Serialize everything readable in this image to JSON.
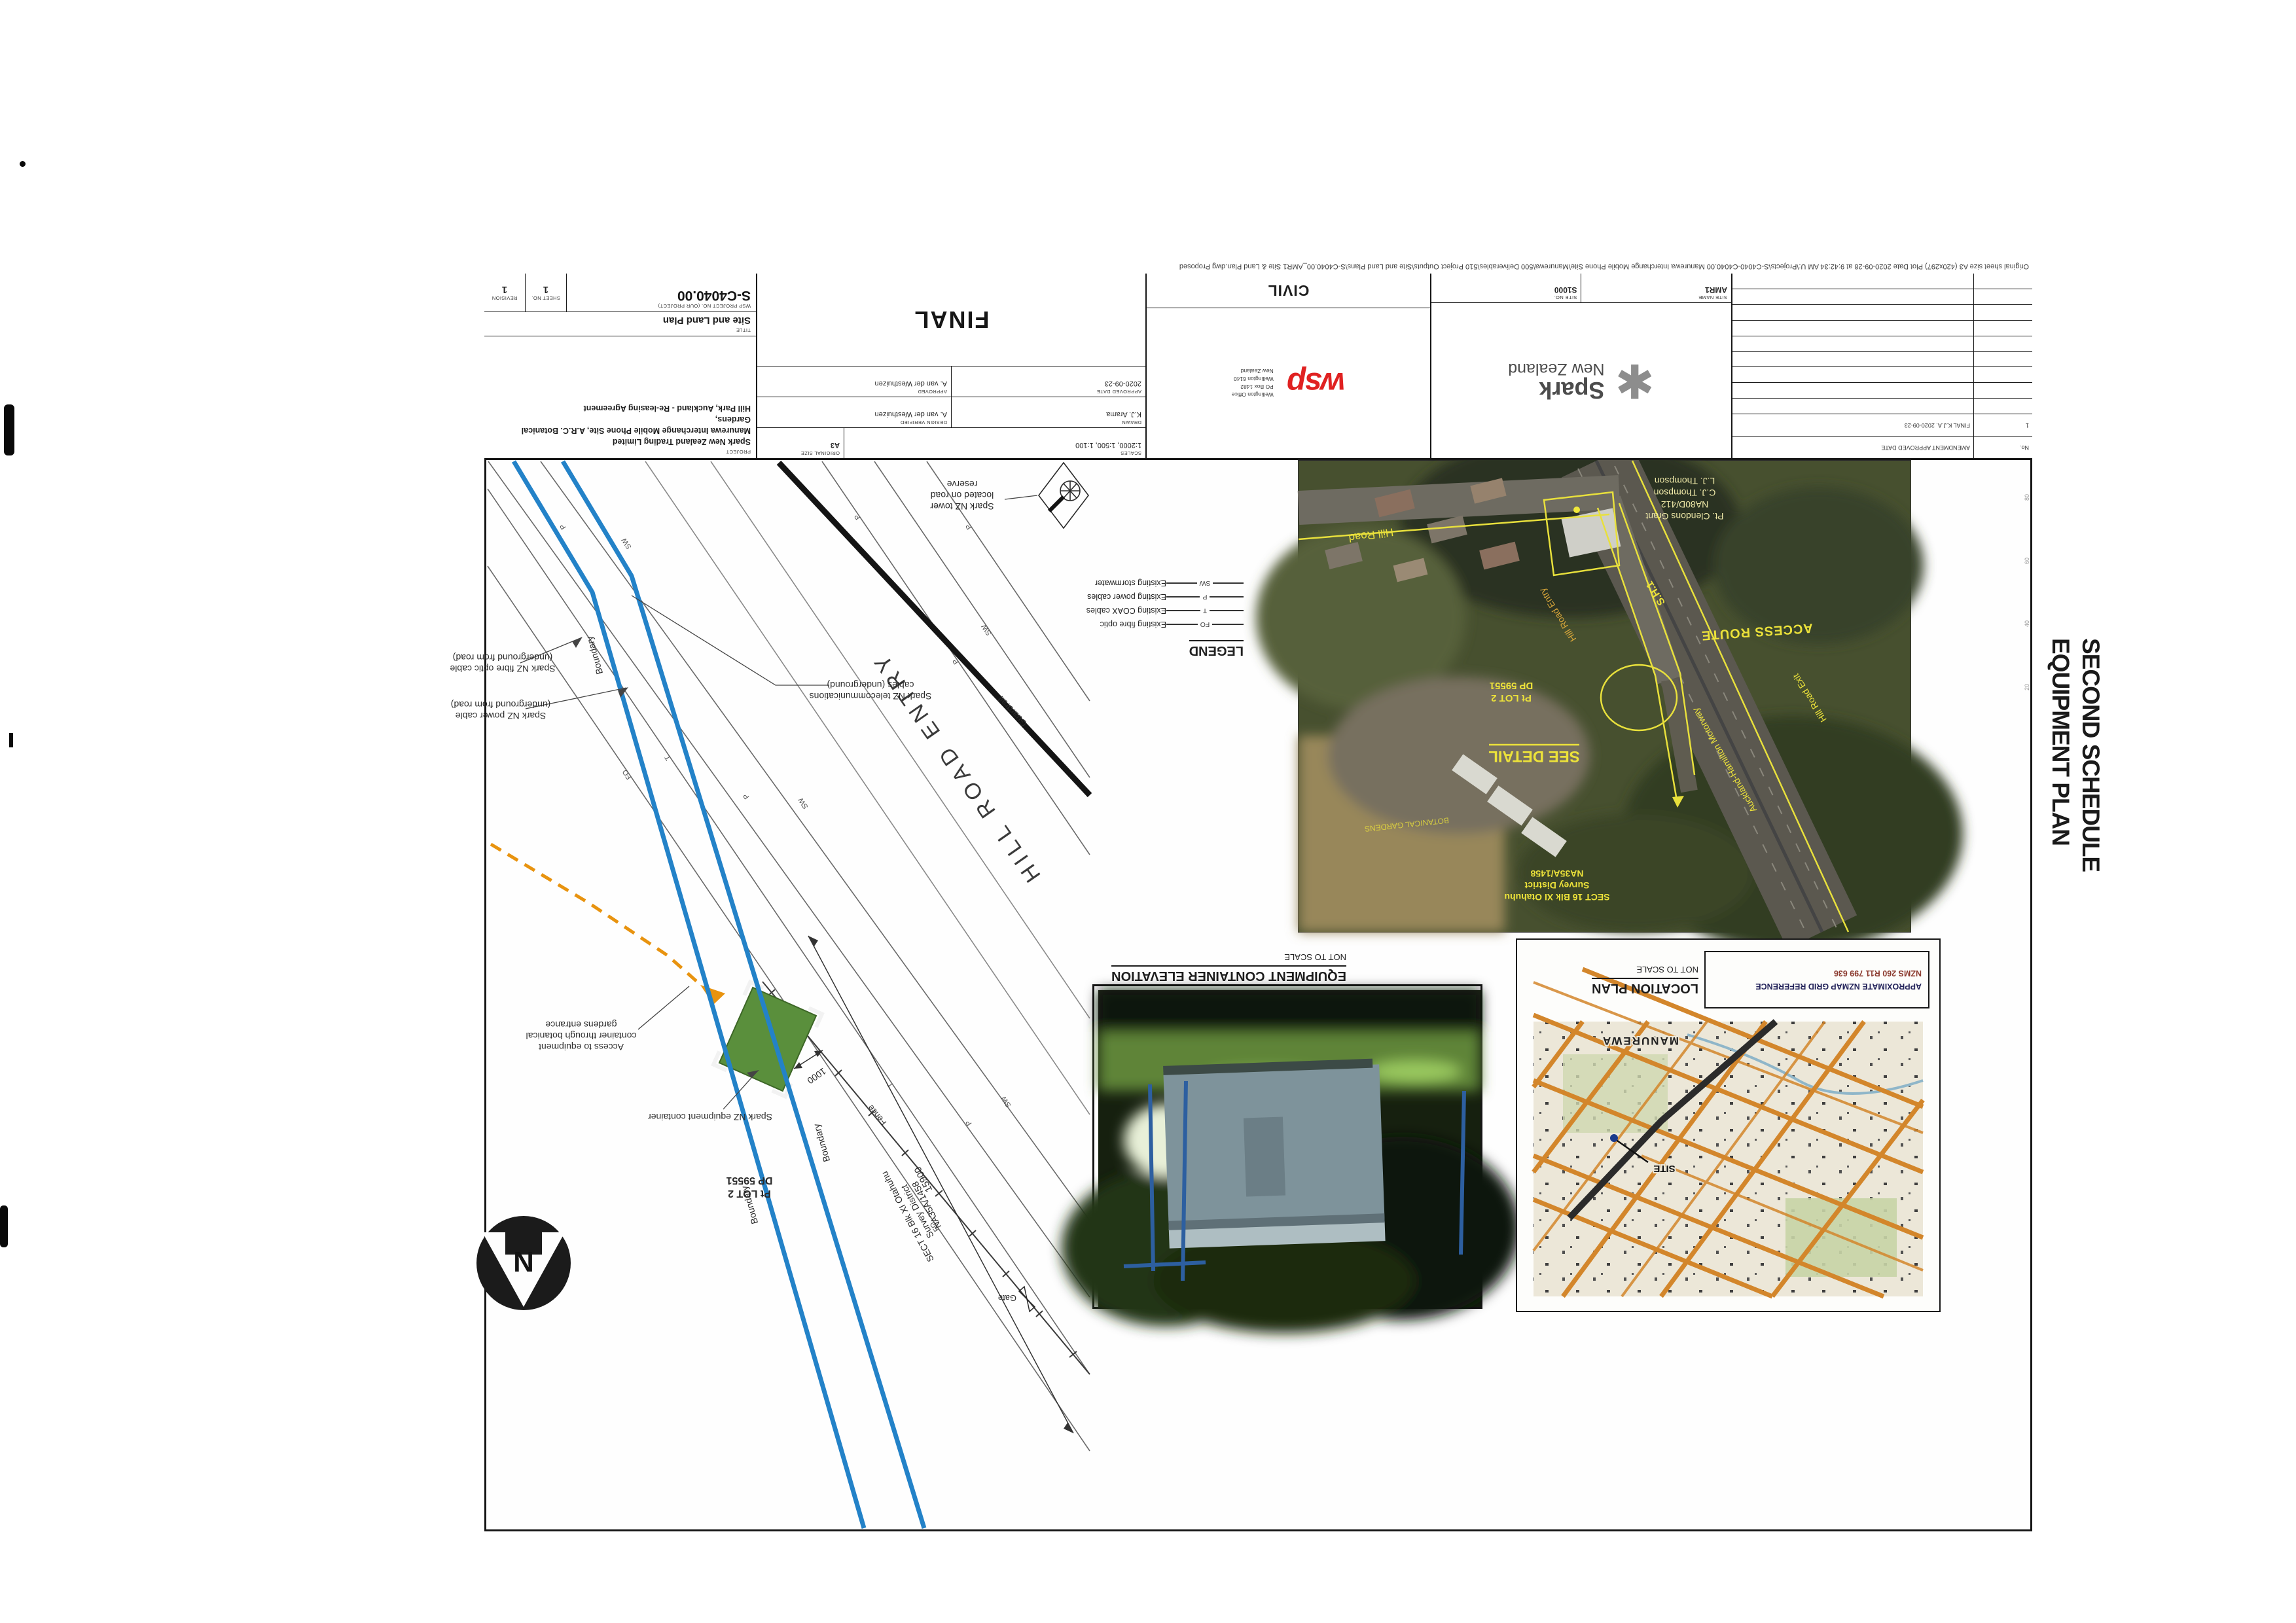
{
  "overlay": {
    "line1": "SECOND SCHEDULE",
    "line2": "EQUIPMENT PLAN"
  },
  "edge_note": "Original sheet size A3 (420x297)      Plot Date  2020-09-28 at 9:42:34 AM      U:\\Projects\\S-C4040-C4040.00 Manurewa Interchange Mobile Phone Site\\Manurewa\\500 Deliverables\\510 Project Outputs\\Site and Land Plans\\S-C4040.00_AMR1 Site & Land Plan.dwg Proposed",
  "ruler": [
    "20",
    "40",
    "60",
    "80"
  ],
  "titleblock": {
    "revisions": {
      "no_header": "No.",
      "header": "AMENDMENT                APPROVED        DATE",
      "row_no": "1",
      "row_text": "FINAL      K.J.A.      2020-09-23"
    },
    "spark": {
      "star": "✱",
      "brand1": "Spark",
      "brand2": "New Zealand",
      "site_no_label": "SITE No.",
      "site_no": "S1000",
      "site_name_label": "SITE NAME",
      "site_name": "AMR1"
    },
    "wsp": {
      "logo": "wsp",
      "office": [
        "Wellington Office",
        "PO Box 1482",
        "Wellington 6140",
        "New Zealand"
      ],
      "discipline": "CIVIL"
    },
    "approvals": {
      "scales_label": "SCALES",
      "scales": "1:2000, 1:500, 1:100",
      "size_label": "ORIGINAL SIZE",
      "size": "A3",
      "drawn_label": "DRAWN",
      "drawn": "K.J. Arama",
      "verified_label": "DESIGN VERIFIED",
      "verified": "A. van der Westhuizen",
      "approved_label": "APPROVED",
      "approved": "A. van der Westhuizen",
      "date_label": "APPROVED DATE",
      "date": "2020-09-23",
      "status": "FINAL"
    },
    "project": {
      "project_label": "PROJECT",
      "line1": "Spark New Zealand Trading Limited",
      "line2": "Manurewa Interchange Mobile Phone Site, A.R.C. Botanical Gardens,",
      "line3": "Hill Park, Auckland - Re-leasing Agreement",
      "title_label": "TITLE",
      "title": "Site and Land Plan",
      "number_label": "WSP PROJECT No. (OUR PROJECT)",
      "number": "S-C4040.00",
      "sheet_label": "SHEET No.",
      "sheet": "1",
      "revision_label": "REVISION",
      "revision": "1"
    }
  },
  "detail": {
    "caption_title": "DETAIL",
    "caption_scale": "SCALE 1:500",
    "labels": {
      "tower": [
        "Spark NZ tower",
        "located on road",
        "reserve"
      ],
      "telecom": [
        "Spark NZ telecommunications",
        "cables (underground)"
      ],
      "fibre": [
        "Spark NZ fibre optic cable",
        "(underground from road)"
      ],
      "power": [
        "Spark NZ power cable",
        "(underground from road)"
      ],
      "access": [
        "Access to equipment",
        "container through botanical",
        "gardens entrance"
      ],
      "equip": "Spark NZ equipment container",
      "lot1": "Pt LOT 2",
      "lot2": "DP 59551",
      "sect": [
        "SECT 16 Blk XI Otahuhu",
        "Survey District",
        "NA35A/1458"
      ],
      "road": "HILL ROAD ENTRY",
      "guardrail": "Guardrail",
      "boundary": "Boundary",
      "fence": "Fence",
      "gate": "Gate",
      "dim_long": "15900",
      "dim_short": "1000",
      "north": "N",
      "fo": "FO",
      "t": "T",
      "p": "P",
      "sw": "SW"
    }
  },
  "plan_caption": {
    "title": "PLAN",
    "scale": "SCALE 1:2000"
  },
  "aerial": {
    "hill_road": "Hill Road",
    "entry": "Hill Road Entry",
    "exit": "Hill Road Exit",
    "sh1": "S.H.1",
    "access_route": "ACCESS ROUTE",
    "motorway": "Auckland-Hamilton Motorway",
    "see_detail": "SEE DETAIL",
    "lot1": "Pt LOT 2",
    "lot2": "DP 59551",
    "sect1": "SECT 16 Blk XI Otahuhu",
    "sect2": "Survey District",
    "sect3": "NA35A/1458",
    "botanical": "BOTANICAL GARDENS",
    "grant1": "Pt. Clendons Grant",
    "grant2": "NA80D/412",
    "grant3": "C.J. Thompson",
    "grant4": "L.J. Thompson"
  },
  "legend": {
    "title": "LEGEND",
    "items": [
      {
        "code": "FO",
        "label": "Existing fibre optic"
      },
      {
        "code": "T",
        "label": "Existing COAX cables"
      },
      {
        "code": "P",
        "label": "Existing power cables"
      },
      {
        "code": "SW",
        "label": "Existing stormwater"
      }
    ]
  },
  "elevation": {
    "title": "EQUIPMENT CONTAINER ELEVATION",
    "scale": "NOT TO SCALE"
  },
  "location": {
    "title": "LOCATION PLAN",
    "scale": "NOT TO SCALE",
    "gridref_label": "APPROXIMATE NZMAP GRID REFERENCE",
    "gridref": "NZMS 260 R11     799 636",
    "town": "MANUREWA",
    "site": "SITE"
  },
  "colors": {
    "boundary_blue": "#2382c8",
    "access_orange": "#e8930f",
    "container_green": "#5a8f3c",
    "aerial_yellow": "#ece23a",
    "wsp_red": "#e02121",
    "map_orange": "#d3862b"
  }
}
